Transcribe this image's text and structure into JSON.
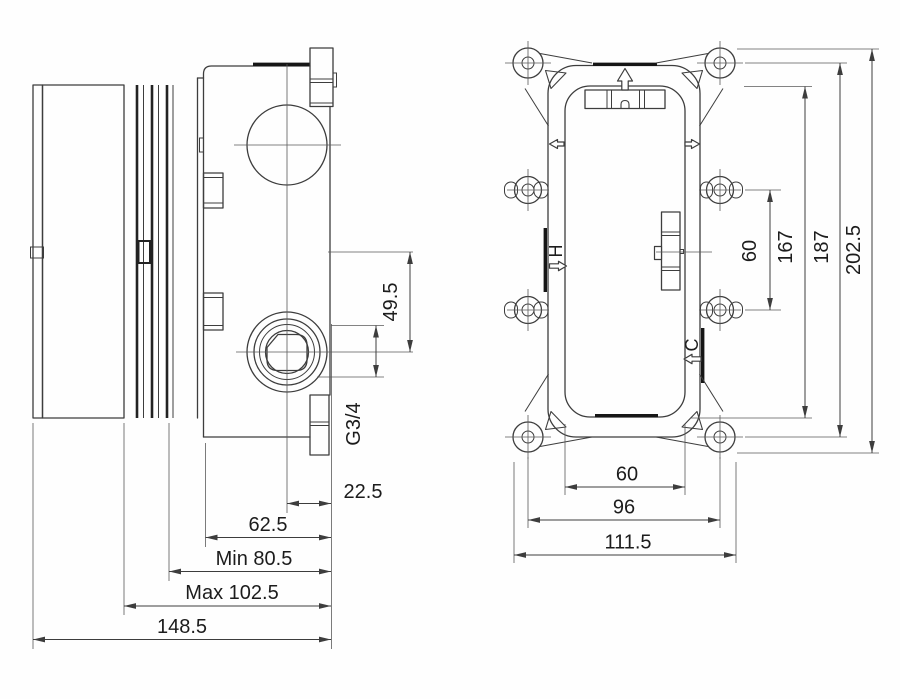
{
  "side": {
    "d49_5": "49.5",
    "thread": "G3/4",
    "d22_5": "22.5",
    "d62_5": "62.5",
    "dmin": "Min 80.5",
    "dmax": "Max 102.5",
    "d148_5": "148.5"
  },
  "front": {
    "hot": "H",
    "cold": "C",
    "d60v": "60",
    "d167": "167",
    "d187": "187",
    "d202_5": "202.5",
    "d60h": "60",
    "d96": "96",
    "d111_5": "111.5"
  },
  "colors": {
    "line": "#3d3d3d",
    "bold": "#161616",
    "text": "#1c1c1c",
    "background": "#fefefe"
  }
}
